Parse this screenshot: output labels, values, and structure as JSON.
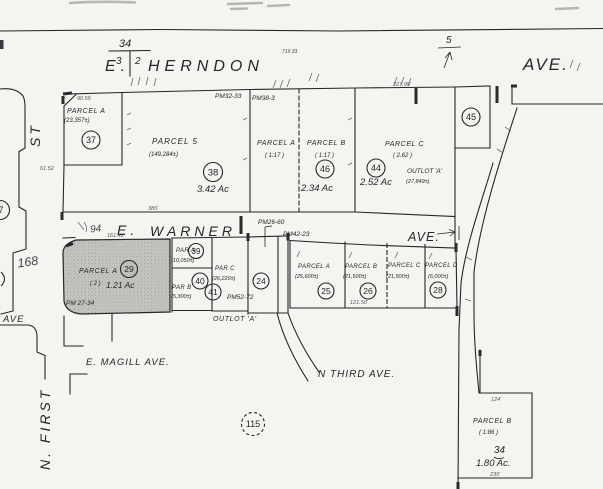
{
  "colors": {
    "ink": "#26262b",
    "paper": "#f5f4f0",
    "shade": "#c5c4c0",
    "faint": "#55555c"
  },
  "streets": {
    "herndon_e": "E.",
    "herndon": "HERNDON",
    "herndon_ave": "AVE.",
    "warner_e": "E.",
    "warner": "WARNER",
    "warner_ave": "AVE.",
    "first_top": "ST",
    "first_bottom": "N. FIRST",
    "magill": "E. MAGILL AVE.",
    "third": "N THIRD AVE.",
    "west_ave": "AVE"
  },
  "markers": {
    "section_top": "34",
    "section_left": "3",
    "section_right": "2",
    "north": "5",
    "west_circle": "7"
  },
  "pm": {
    "pm32": "PM32-33",
    "pm38": "PM38-3",
    "pm26": "PM26-60",
    "pm42": "PM42-23",
    "pm27": "PM 27-34",
    "pm52": "PM52-72"
  },
  "parcels": {
    "a37": {
      "label": "PARCEL A",
      "area": "(23,357±)",
      "num": "37"
    },
    "p5": {
      "label": "PARCEL 5",
      "area": "(149,284±)",
      "num": "38",
      "acres": "3.42 Ac"
    },
    "a17": {
      "label": "PARCEL A",
      "area": "( 1:17 )"
    },
    "b17": {
      "label": "PARCEL B",
      "area": "( 1:17 )",
      "num": "46",
      "acres": "2.34 Ac"
    },
    "c44": {
      "label": "PARCEL C",
      "area": "( 2.62 )",
      "num": "44",
      "acres": "2.52 Ac"
    },
    "outlot_top": {
      "label": "OUTLOT 'A'",
      "area": "(27,849±)"
    },
    "n45": {
      "num": "45"
    },
    "a29": {
      "label": "PARCEL A",
      "extra": "( 2 )",
      "num": "29",
      "acres": "1.21 Ac"
    },
    "par_a": {
      "label": "PAR A",
      "area": "(10,050±)",
      "num": "39"
    },
    "par_b": {
      "label": "PAR B",
      "area": "(5,300±)",
      "num": "40"
    },
    "par_c": {
      "label": "PAR C",
      "area": "(26,220±)",
      "num": "41"
    },
    "n24": {
      "num": "24"
    },
    "a25": {
      "label": "PARCEL A",
      "area": "(25,600±)",
      "num": "25"
    },
    "b26": {
      "label": "PARCEL B",
      "area": "(21,500±)",
      "num": "26"
    },
    "c21": {
      "label": "PARCEL C",
      "area": "(21,500±)"
    },
    "d28": {
      "label": "PARCEL D",
      "area": "(6,000±)",
      "num": "28"
    },
    "outlot_bottom": {
      "label": "OUTLOT 'A'"
    },
    "pb": {
      "label": "PARCEL B",
      "area": "( 1:86 )",
      "section": "34",
      "acres": "1.80 Ac."
    },
    "n115": {
      "num": "115"
    }
  },
  "dims": {
    "d_9055": "90.55",
    "d_22795": "227.95'",
    "d_16142": "161.42'",
    "d_385": "385'",
    "d_6152": "61.52",
    "d_124": "124'",
    "d_235": "235'",
    "d_12150": "121.50'"
  },
  "scribbles": {
    "s94": "94",
    "s168": "168",
    "s719": "719 33"
  }
}
